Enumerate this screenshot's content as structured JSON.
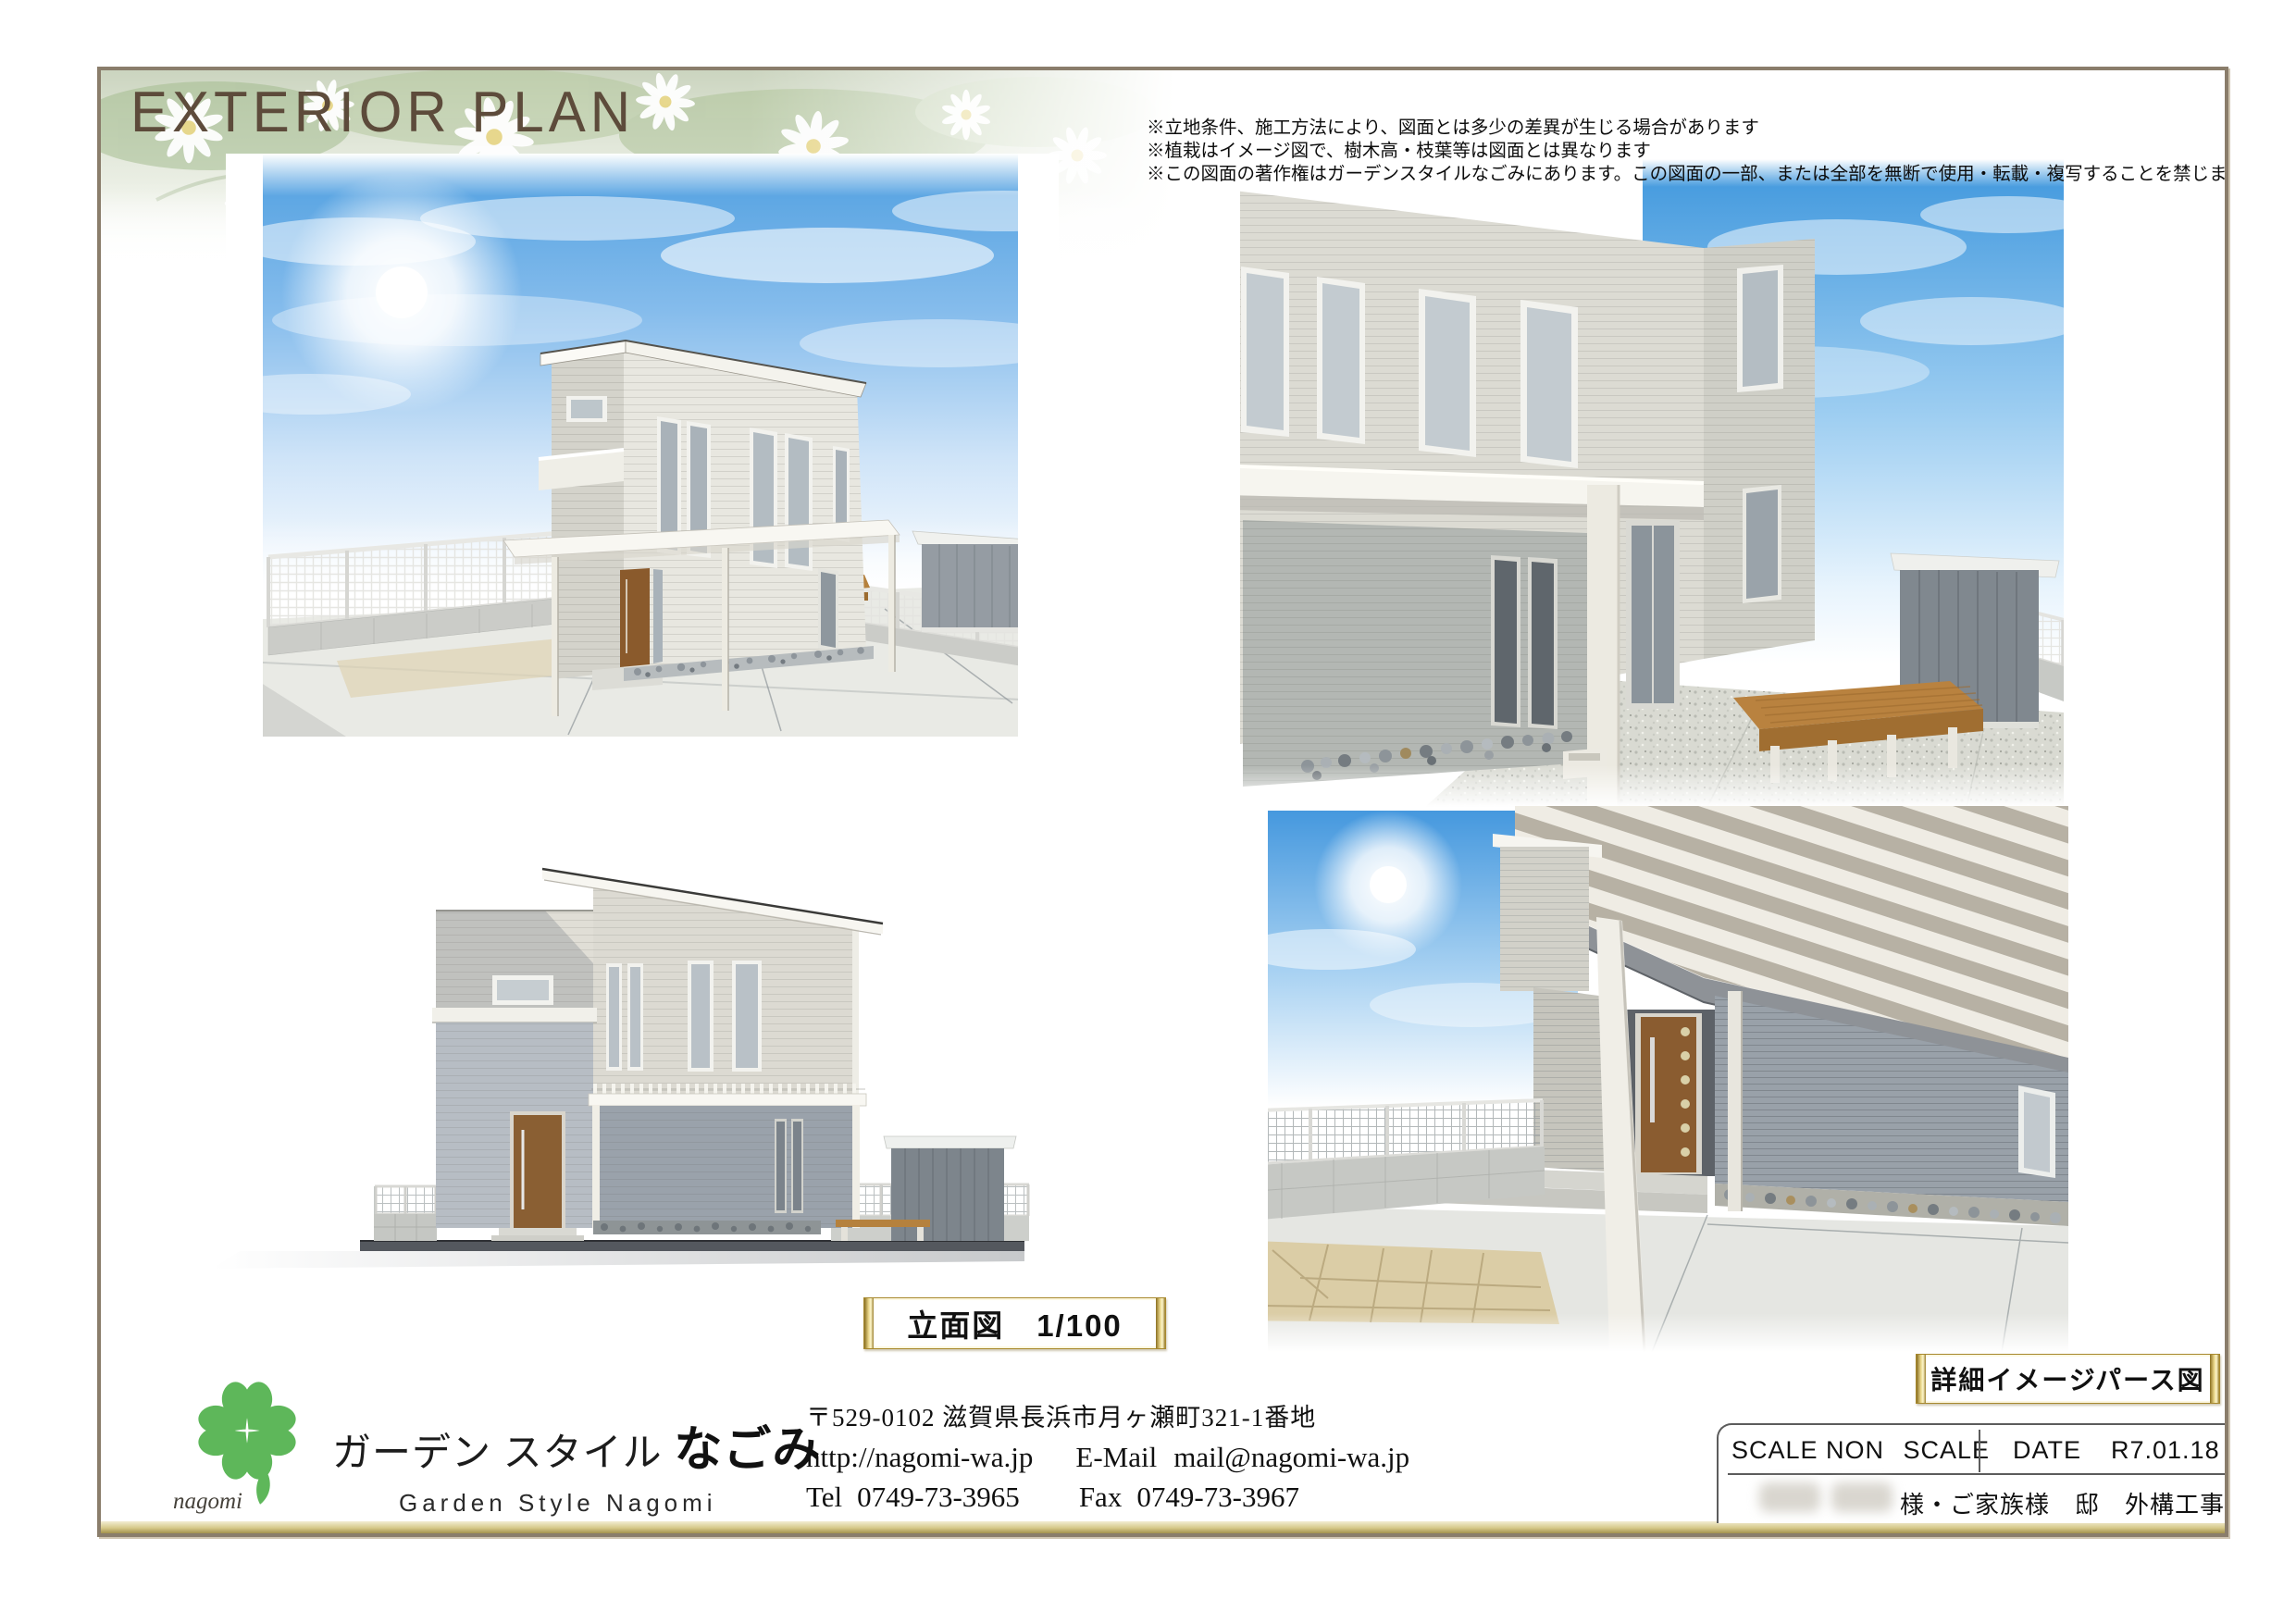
{
  "page": {
    "title": "EXTERIOR PLAN",
    "disclaimers": [
      "※立地条件、施工方法により、図面とは多少の差異が生じる場合があります",
      "※植栽はイメージ図で、樹木高・枝葉等は図面とは異なります",
      "※この図面の著作権はガーデンスタイルなごみにあります。この図面の一部、または全部を無断で使用・転載・複写することを禁じます"
    ]
  },
  "labels": {
    "elevation_caption": "立面図　1/100",
    "detail_caption": "詳細イメージパース図"
  },
  "footer": {
    "logo_text": "nagomi",
    "company_name_jp_prefix": "ガーデン スタイル ",
    "company_name_jp_main": "なごみ",
    "company_name_en": "Garden  Style  Nagomi",
    "address": "〒529-0102  滋賀県長浜市月ヶ瀬町321-1番地",
    "website": "http://nagomi-wa.jp",
    "email_label": "E-Mail",
    "email": "mail@nagomi-wa.jp",
    "tel_label": "Tel",
    "tel": "0749-73-3965",
    "fax_label": "Fax",
    "fax": "0749-73-3967"
  },
  "title_block": {
    "scale_label": "SCALE",
    "scale_value": "NON SCALE",
    "date_label": "DATE",
    "date_value": "R7.01.18",
    "project_line": "様・ご家族様　邸　外構工事④"
  },
  "colors": {
    "frame_brown": "#8a7d6b",
    "gold_dark": "#9c8436",
    "gold_light": "#fdf6cc",
    "title_brown": "#5d4b3b",
    "logo_green": "#5eb75a",
    "sky_blue": "#4f9fe0",
    "wood_deck": "#b9823f",
    "door_wood": "#8a5c30"
  }
}
